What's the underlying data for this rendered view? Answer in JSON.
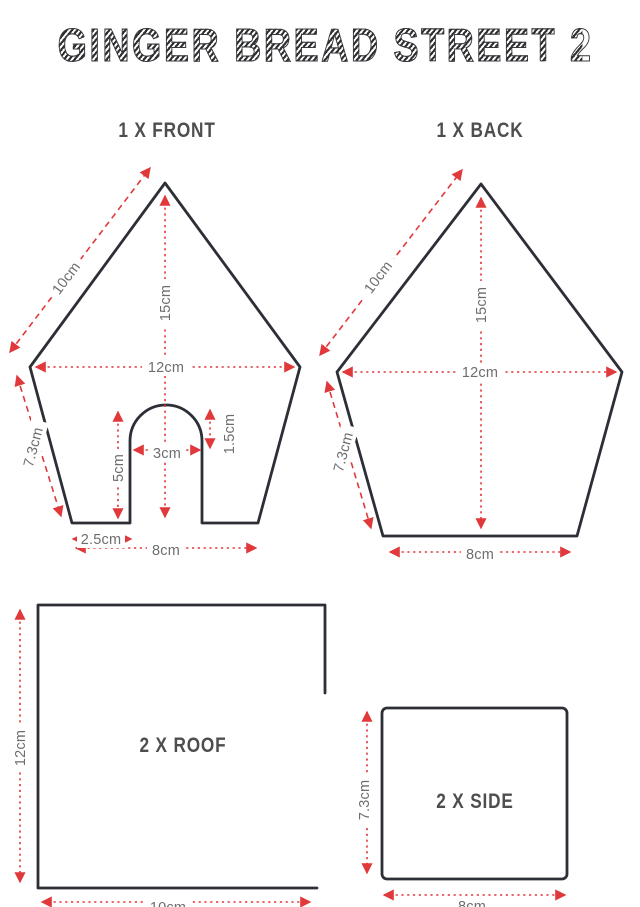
{
  "title": "GINGER BREAD STREET 2",
  "colors": {
    "outline": "#2c2f36",
    "dimension_red": "#e0393c",
    "dim_label_gray": "#6e6e6e",
    "heading_gray": "#4d4e50",
    "background": "#ffffff"
  },
  "panels": {
    "front": {
      "heading": "1 X FRONT",
      "dims": {
        "roof_slope": "10cm",
        "peak_height": "15cm",
        "max_width": "12cm",
        "side_height": "7.3cm",
        "door_height": "5cm",
        "door_width": "3cm",
        "door_arch": "1.5cm",
        "door_offset": "2.5cm",
        "base_width": "8cm"
      }
    },
    "back": {
      "heading": "1 X BACK",
      "dims": {
        "roof_slope": "10cm",
        "peak_height": "15cm",
        "max_width": "12cm",
        "side_height": "7.3cm",
        "base_width": "8cm"
      }
    },
    "roof": {
      "heading": "2 X ROOF",
      "dims": {
        "height": "12cm",
        "width": "10cm"
      }
    },
    "side": {
      "heading": "2 X SIDE",
      "dims": {
        "height": "7.3cm",
        "width": "8cm"
      }
    }
  }
}
